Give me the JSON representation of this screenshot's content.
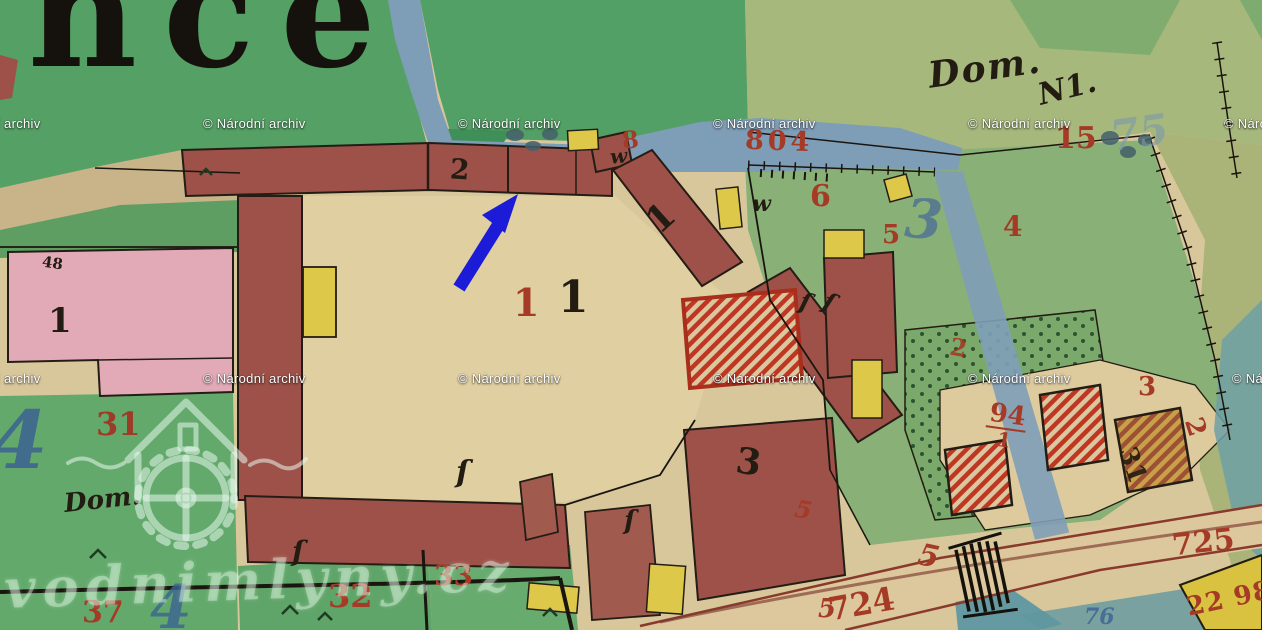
{
  "map": {
    "title_fragment": "ince",
    "labels": {
      "t_dom_top": "Dom.",
      "t_n1": "N1.",
      "t_15": "15",
      "t_75": "75",
      "t_2": "2",
      "t_8": "8",
      "t_w1": "w",
      "t_804": "804",
      "t_w2": "w",
      "t_6": "6",
      "t_5a": "5",
      "t_blue3": "3",
      "t_4a": "4",
      "t_diag1": "1",
      "t_red1": "1",
      "t_black1": "1",
      "t_pink1": "1",
      "t_48": "48",
      "t_blue4": "4",
      "t_31": "31",
      "t_dom2": "Dom.",
      "t_37": "37",
      "t_blue4b": "4",
      "t_32": "32",
      "t_33": "33",
      "t_3": "3",
      "t_724": "724",
      "t_725": "725",
      "t_2298": "22 98",
      "t_5road": "5",
      "t_5road2": "5",
      "t_5road3": "5",
      "t_blue76": "76",
      "t_94": "94",
      "t_94d": "1",
      "t_red3b": "3",
      "t_red2b": "2",
      "t_black31": "31",
      "t_orch2": "2",
      "t_gate": "ſ"
    }
  },
  "watermarks": {
    "archive": "© Národní archiv",
    "site": "vodnimlyny.cz"
  },
  "arrow": {
    "color": "#1b1bd8",
    "meaning": "pointer-annotation"
  },
  "palette": {
    "paper_tan": "#d9c79c",
    "courtyard_tan": "#e0cfa0",
    "field_green": "#55a065",
    "parcel_green": "#8db377",
    "building_red": "#9d5148",
    "highlight_red": "#c03a25",
    "pink": "#e2a9b6",
    "yellow": "#ddc84a",
    "water_blue": "#7e9db6",
    "water_teal": "#669aa2",
    "red_ink": "#a53a26",
    "blue_ink": "#43648e",
    "black_ink": "#221c12"
  }
}
